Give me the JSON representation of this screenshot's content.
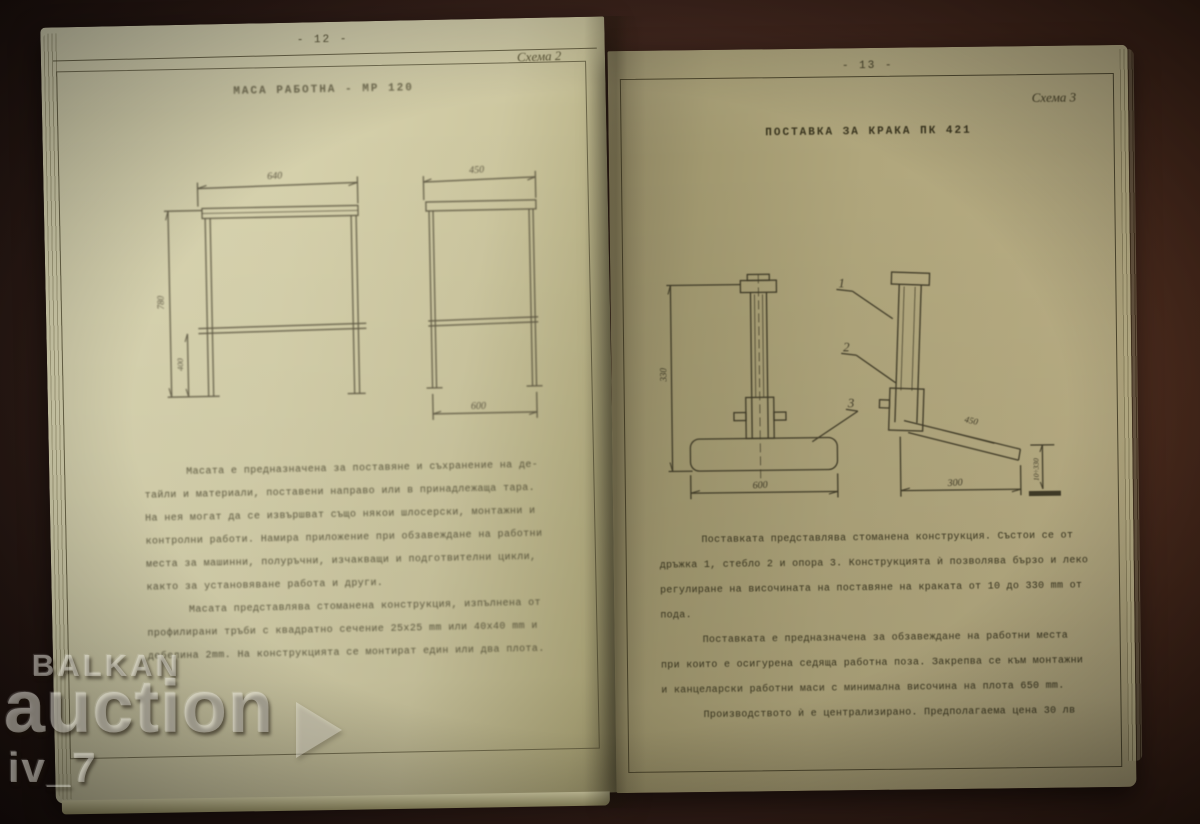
{
  "watermark": {
    "line1": "BALKAN",
    "line2": "auction",
    "line3": "iv_7",
    "play_icon": "play-triangle"
  },
  "left_page": {
    "page_number": "- 12 -",
    "scheme_label": "Схема 2",
    "title": "МАСА РАБОТНА - МР 120",
    "drawing": {
      "front_top_width": "640",
      "overall_height": "780",
      "shelf_height": "400",
      "side_top_depth": "450",
      "side_bottom_depth": "600"
    },
    "para1": [
      "Масата е предназначена за поставяне и съхранение на де-",
      "тайли и материали, поставени направо или в принадлежаща тара.",
      "На нея могат да се извършват също някои шлосерски, монтажни и",
      "контролни работи. Намира приложение при обзавеждане на работни",
      "места за машинни, полуръчни, изчакващи и подготвителни цикли,",
      "както за установяване работа и други."
    ],
    "para2": [
      "Масата представлява стоманена конструкция, изпълнена от",
      "профилирани тръби с квадратно сечение 25x25 mm или 40x40 mm и",
      "дебелина 2mm. На конструкцията се монтират един или два плота."
    ]
  },
  "right_page": {
    "page_number": "- 13 -",
    "scheme_label": "Схема 3",
    "title": "ПОСТАВКА ЗА КРАКА ПК 421",
    "drawing": {
      "overall_height": "330",
      "base_width": "600",
      "side_base_depth": "300",
      "plate_length": "450",
      "adjust_range": "10÷330",
      "callout_1": "1",
      "callout_2": "2",
      "callout_3": "3"
    },
    "para1": [
      "Поставката представлява стоманена конструкция. Състои се от",
      "дръжка 1, стебло 2 и опора 3. Конструкцията ѝ позволява бързо и леко",
      "регулиране на височината на поставяне на краката от 10 до 330 mm от",
      "пода."
    ],
    "para2": [
      "Поставката е предназначена за обзавеждане на работни места",
      "при които е осигурена седяща работна поза. Закрепва се към монтажни",
      "и канцеларски работни маси с минимална височина на плота 650 mm."
    ],
    "para3": [
      "Производството ѝ е централизирано. Предполагаема цена 30 лв"
    ]
  }
}
